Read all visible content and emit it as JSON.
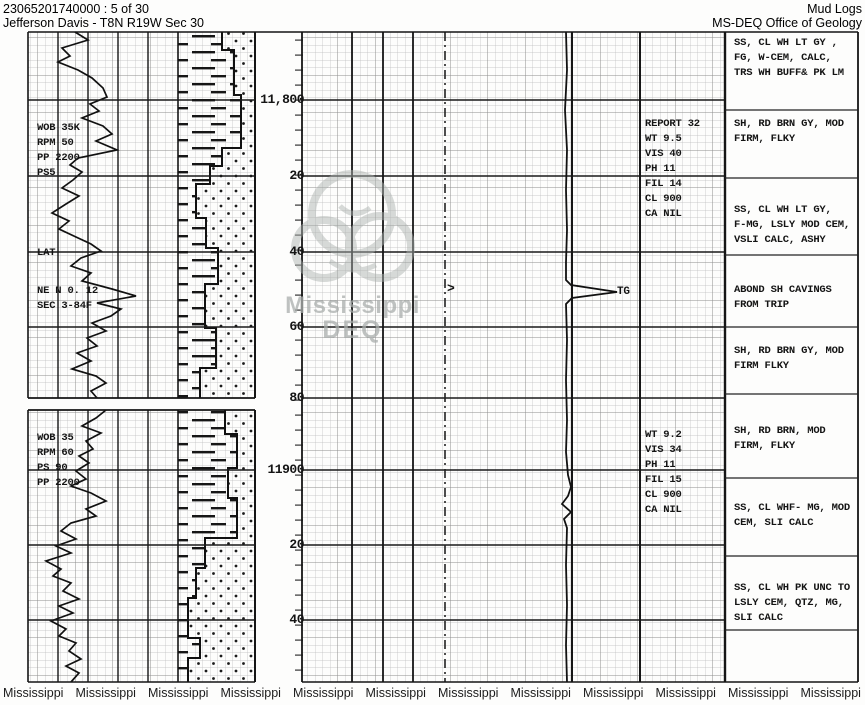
{
  "header": {
    "doc_id": "23065201740000 : 5 of 30",
    "well_name": "Jefferson Davis - T8N R19W Sec 30",
    "doc_type": "Mud Logs",
    "agency": "MS-DEQ Office of Geology"
  },
  "depth_scale": {
    "labels": [
      "11,800",
      "20",
      "40",
      "60",
      "80",
      "11900",
      "20",
      "40"
    ]
  },
  "annotations": {
    "drill_params_upper": "WOB 35K\nRPM 50\nPP 2200\nPS5",
    "lat_label": "LAT",
    "survey_note": "NE N 0. 12\nSEC 3-84F",
    "drill_params_lower": "WOB 35\nRPM 60\nPS 90\nPP 2200",
    "mud_report_upper": "REPORT 32\nWT 9.5\nVIS 40\nPH 11\nFIL 14\nCL 900\nCA NIL",
    "mud_report_lower": "WT 9.2\nVIS 34\nPH 11\nFIL 15\nCL 900\nCA NIL",
    "total_gas_label": "TG",
    "marker_arrow": ">"
  },
  "lithology_descriptions": [
    "SS, CL WH LT GY ,\nFG, W-CEM, CALC,\nTRS WH BUFF& PK LM",
    "SH, RD BRN GY, MOD\nFIRM, FLKY",
    "SS, CL WH LT GY,\nF-MG, LSLY MOD CEM,\nVSLI CALC, ASHY",
    "ABOND SH CAVINGS\nFROM TRIP",
    "SH, RD BRN GY, MOD\nFIRM FLKY",
    "SH, RD BRN, MOD\nFIRM, FLKY",
    "SS, CL WHF- MG, MOD\nCEM, SLI CALC",
    "SS, CL WH PK UNC TO\nLSLY CEM, QTZ, MG,\nSLI CALC"
  ],
  "watermark": {
    "name": "Mississippi",
    "org": "DEQ"
  },
  "footer_watermarks": [
    "Mississippi",
    "Mississippi",
    "Mississippi",
    "Mississippi",
    "Mississippi",
    "Mississippi",
    "Mississippi",
    "Mississippi",
    "Mississippi",
    "Mississippi",
    "Mississippi",
    "Mississippi"
  ]
}
